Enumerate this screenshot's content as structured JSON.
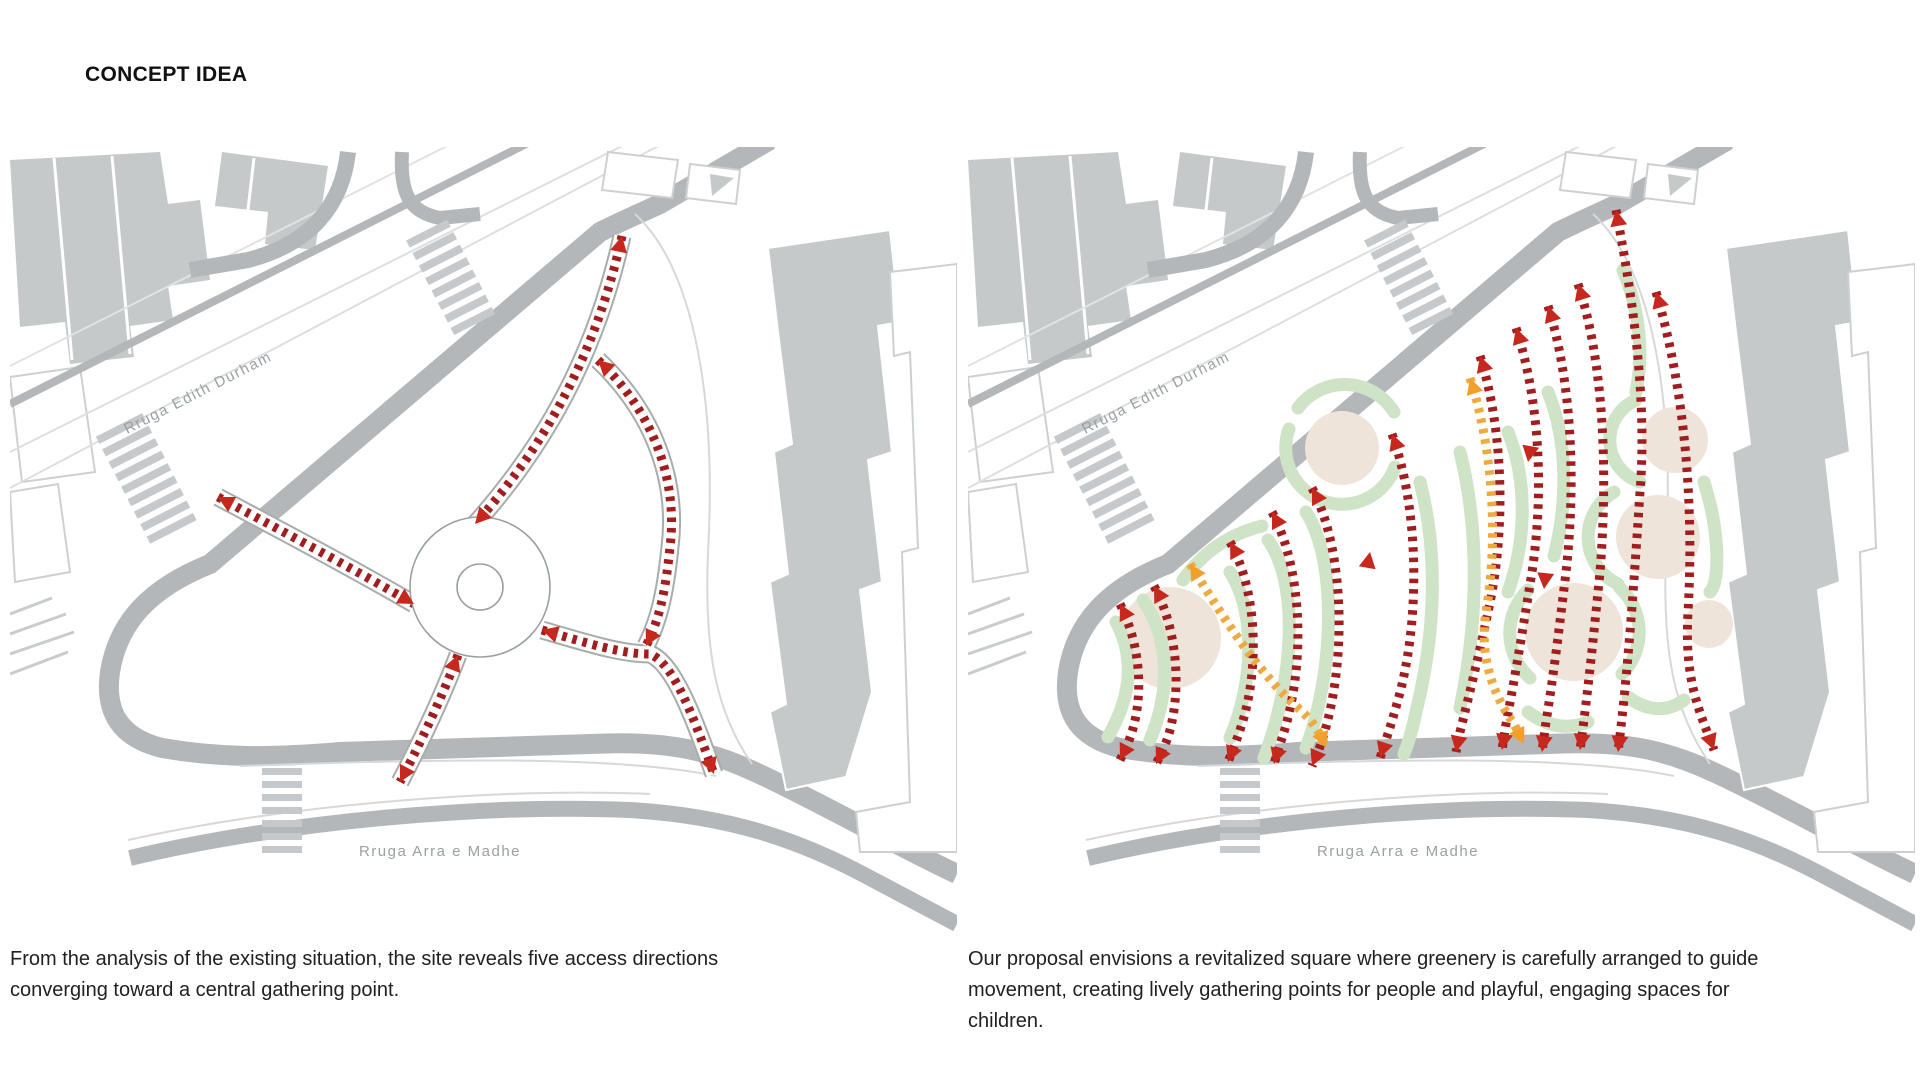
{
  "slide": {
    "title": "CONCEPT IDEA"
  },
  "panels": [
    {
      "id": "existing-site-analysis",
      "street_labels": {
        "edith_durham": "Rruga Edith Durham",
        "arra_e_madhe": "Rruga Arra e Madhe"
      },
      "caption": "From the analysis of the existing situation, the site reveals five access directions converging toward a central gathering point.",
      "access_directions_count": 5,
      "central_gathering_point": true
    },
    {
      "id": "proposal-concept",
      "street_labels": {
        "edith_durham": "Rruga Edith Durham",
        "arra_e_madhe": "Rruga Arra e Madhe"
      },
      "caption": "Our proposal envisions a revitalized square where greenery is carefully arranged to guide movement, creating lively gathering points for people and playful, engaging spaces for children."
    }
  ],
  "colors": {
    "movement_arrow_red": "#a21d1d",
    "arrowhead_red": "#c7281d",
    "play_path_orange": "#eeaa3f",
    "arrowhead_orange": "#f29f2c",
    "greenery_band": "#cfe3c6",
    "gathering_circle_beige": "#efe4da",
    "road_gray": "#b4b7b9",
    "building_gray": "#c6c9ca",
    "street_label_gray": "#9aa0a3",
    "caption_text": "#202124"
  }
}
